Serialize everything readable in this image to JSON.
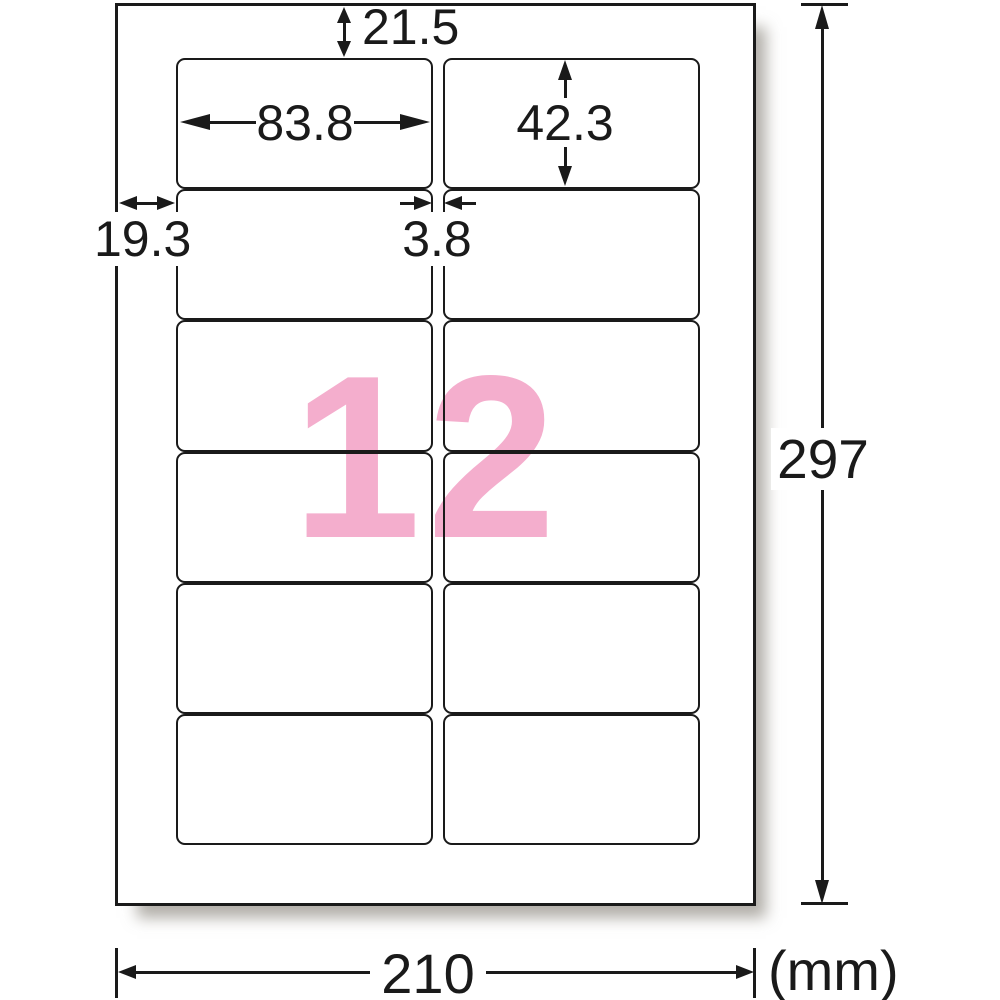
{
  "diagram": {
    "title": "label-sheet-dimension-diagram",
    "count_label": "12",
    "unit_label": "(mm)",
    "grid": {
      "rows": 6,
      "columns": 2,
      "label_count": 12
    },
    "dimensions": {
      "top_margin": "21.5",
      "label_width": "83.8",
      "label_height": "42.3",
      "left_margin": "19.3",
      "column_gap": "3.8",
      "sheet_height": "297",
      "sheet_width": "210"
    },
    "colors": {
      "count_pink": "#f4aecd",
      "line": "#1a1a1a",
      "paper": "#ffffff"
    }
  }
}
